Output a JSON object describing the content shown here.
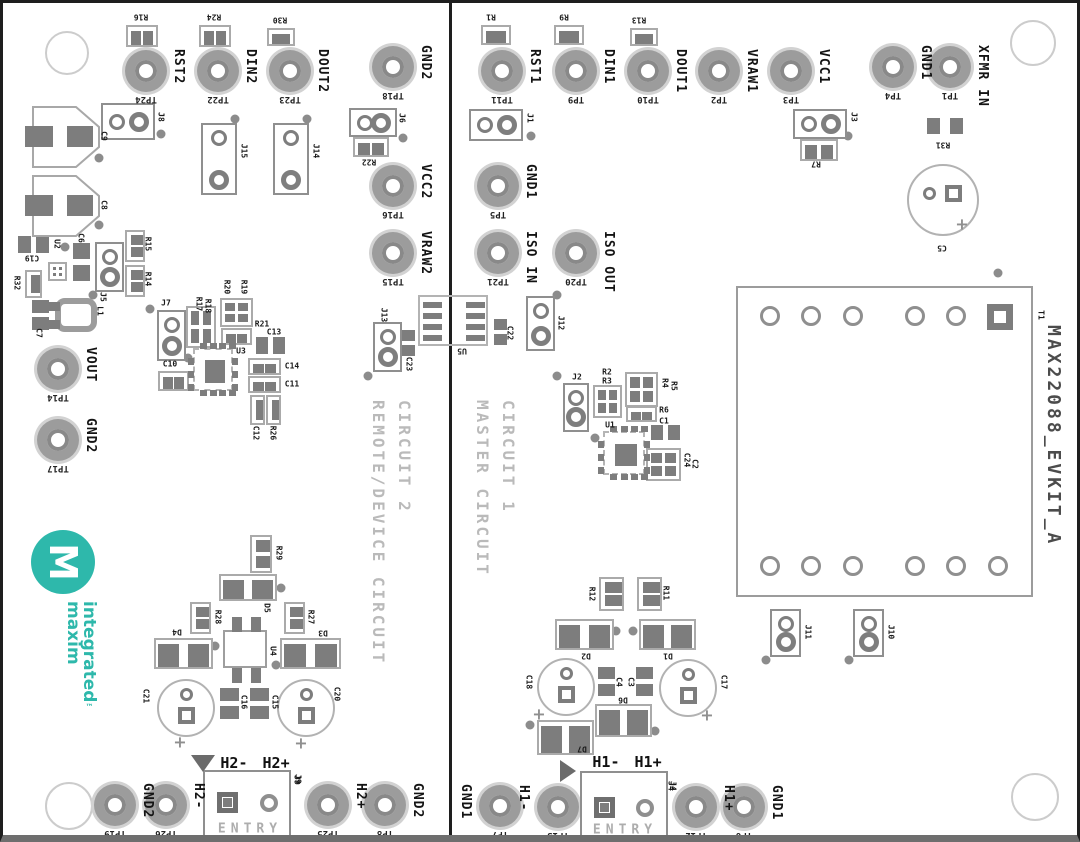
{
  "board_title": "MAX22088_EVKIT_A",
  "titles": {
    "circuit1_line1": "CIRCUIT 1",
    "circuit1_line2": "MASTER CIRCUIT",
    "circuit2_line1": "CIRCUIT 2",
    "circuit2_line2": "REMOTE/DEVICE CIRCUIT"
  },
  "logo": {
    "word1": "maxim",
    "word2": "integrated",
    "tm": "™",
    "monogram": "M"
  },
  "entry": {
    "label": "ENTRY"
  },
  "colors": {
    "teal": "#2eb8ab",
    "pad": "#7d7d7d",
    "outline": "#aaaaaa",
    "silk": "#1a1a1a",
    "faint": "#bababa",
    "title_gray": "#4c4c4c"
  },
  "testpoints": [
    {
      "net": "RST2",
      "tp": "TP24",
      "x": 143,
      "y": 68
    },
    {
      "net": "DIN2",
      "tp": "TP22",
      "x": 215,
      "y": 68
    },
    {
      "net": "DOUT2",
      "tp": "TP23",
      "x": 287,
      "y": 68
    },
    {
      "net": "GND2",
      "tp": "TP18",
      "x": 390,
      "y": 64
    },
    {
      "net": "VCC2",
      "tp": "TP16",
      "x": 390,
      "y": 183
    },
    {
      "net": "VRAW2",
      "tp": "TP15",
      "x": 390,
      "y": 250
    },
    {
      "net": "VOUT",
      "tp": "TP14",
      "x": 55,
      "y": 366
    },
    {
      "net": "GND2",
      "tp": "TP17",
      "x": 55,
      "y": 437
    },
    {
      "net": "GND2",
      "tp": "TP19",
      "x": 112,
      "y": 802
    },
    {
      "net": "H2-",
      "tp": "TP26",
      "x": 163,
      "y": 802
    },
    {
      "net": "H2+",
      "tp": "TP25",
      "x": 325,
      "y": 802
    },
    {
      "net": "GND2",
      "tp": "TP8",
      "x": 382,
      "y": 802
    },
    {
      "net": "RST1",
      "tp": "TP11",
      "x": 499,
      "y": 68
    },
    {
      "net": "DIN1",
      "tp": "TP9",
      "x": 573,
      "y": 68
    },
    {
      "net": "DOUT1",
      "tp": "TP10",
      "x": 645,
      "y": 68
    },
    {
      "net": "VRAW1",
      "tp": "TP2",
      "x": 716,
      "y": 68
    },
    {
      "net": "VCC1",
      "tp": "TP3",
      "x": 788,
      "y": 68
    },
    {
      "net": "GND1",
      "tp": "TP4",
      "x": 890,
      "y": 64
    },
    {
      "net": "XFMR IN",
      "tp": "TP1",
      "x": 947,
      "y": 64
    },
    {
      "net": "GND1",
      "tp": "TP5",
      "x": 495,
      "y": 183
    },
    {
      "net": "ISO IN",
      "tp": "TP21",
      "x": 495,
      "y": 250
    },
    {
      "net": "ISO OUT",
      "tp": "TP20",
      "x": 573,
      "y": 250
    },
    {
      "net": "GND1",
      "tp": "TP7",
      "x": 497,
      "y": 803,
      "side": "left"
    },
    {
      "net": "H1-",
      "tp": "TP13",
      "x": 555,
      "y": 804,
      "side": "left"
    },
    {
      "net": "H1+",
      "tp": "TP12",
      "x": 693,
      "y": 804
    },
    {
      "net": "GND1",
      "tp": "TP6",
      "x": 741,
      "y": 804
    }
  ],
  "jumpers": [
    {
      "r": "J8",
      "x": 98,
      "y": 100,
      "w": 54,
      "h": 37,
      "o": "h"
    },
    {
      "r": "J15",
      "x": 198,
      "y": 120,
      "w": 36,
      "h": 72,
      "o": "v"
    },
    {
      "r": "J14",
      "x": 270,
      "y": 120,
      "w": 36,
      "h": 72,
      "o": "v"
    },
    {
      "r": "J6",
      "x": 346,
      "y": 105,
      "w": 48,
      "h": 29,
      "o": "h"
    },
    {
      "r": "J1",
      "x": 466,
      "y": 106,
      "w": 54,
      "h": 32,
      "o": "h"
    },
    {
      "r": "J3",
      "x": 790,
      "y": 106,
      "w": 54,
      "h": 30,
      "o": "h"
    },
    {
      "r": "J5",
      "x": 92,
      "y": 239,
      "w": 29,
      "h": 50,
      "o": "v"
    },
    {
      "r": "J7",
      "x": 154,
      "y": 307,
      "w": 29,
      "h": 51,
      "o": "v"
    },
    {
      "r": "J13",
      "x": 370,
      "y": 319,
      "w": 29,
      "h": 50,
      "o": "v"
    },
    {
      "r": "J12",
      "x": 523,
      "y": 293,
      "w": 29,
      "h": 55,
      "o": "v"
    },
    {
      "r": "J2",
      "x": 560,
      "y": 380,
      "w": 26,
      "h": 49,
      "o": "v"
    },
    {
      "r": "J11",
      "x": 767,
      "y": 606,
      "w": 31,
      "h": 48,
      "o": "v"
    },
    {
      "r": "J10",
      "x": 850,
      "y": 606,
      "w": 31,
      "h": 48,
      "o": "v"
    }
  ],
  "resistors": [
    {
      "r": "R16",
      "x": 123,
      "y": 22,
      "w": 32,
      "h": 22,
      "o": "h"
    },
    {
      "r": "R24",
      "x": 196,
      "y": 22,
      "w": 32,
      "h": 22,
      "o": "h"
    },
    {
      "r": "R30",
      "x": 264,
      "y": 25,
      "w": 28,
      "h": 18,
      "o": "h"
    },
    {
      "r": "R22",
      "x": 350,
      "y": 134,
      "w": 36,
      "h": 20,
      "o": "h"
    },
    {
      "r": "R1",
      "x": 478,
      "y": 22,
      "w": 30,
      "h": 20,
      "o": "h"
    },
    {
      "r": "R9",
      "x": 551,
      "y": 22,
      "w": 30,
      "h": 20,
      "o": "h"
    },
    {
      "r": "R13",
      "x": 627,
      "y": 25,
      "w": 28,
      "h": 18,
      "o": "h"
    },
    {
      "r": "R7",
      "x": 797,
      "y": 136,
      "w": 38,
      "h": 22,
      "o": "h"
    },
    {
      "r": "R31",
      "x": 921,
      "y": 111,
      "w": 42,
      "h": 24,
      "o": "h",
      "outline": false
    },
    {
      "r": "R15",
      "x": 122,
      "y": 227,
      "w": 20,
      "h": 32,
      "o": "v"
    },
    {
      "r": "R14",
      "x": 122,
      "y": 262,
      "w": 20,
      "h": 32,
      "o": "v"
    },
    {
      "r": "R32",
      "x": 22,
      "y": 267,
      "w": 17,
      "h": 28,
      "o": "v"
    },
    {
      "r": "R29",
      "x": 247,
      "y": 532,
      "w": 22,
      "h": 38,
      "o": "v"
    },
    {
      "r": "R28",
      "x": 187,
      "y": 599,
      "w": 21,
      "h": 32,
      "o": "v"
    },
    {
      "r": "R27",
      "x": 281,
      "y": 599,
      "w": 21,
      "h": 32,
      "o": "v"
    },
    {
      "r": "R12",
      "x": 596,
      "y": 574,
      "w": 25,
      "h": 34,
      "o": "v"
    },
    {
      "r": "R11",
      "x": 634,
      "y": 574,
      "w": 25,
      "h": 34,
      "o": "v"
    },
    {
      "r": "C12",
      "x": 247,
      "y": 392,
      "w": 15,
      "h": 30,
      "o": "v"
    },
    {
      "r": "R26",
      "x": 263,
      "y": 392,
      "w": 15,
      "h": 30,
      "o": "v"
    },
    {
      "r": "R21",
      "x": 218,
      "y": 325,
      "w": 31,
      "h": 17,
      "o": "h"
    },
    {
      "r": "R6",
      "x": 623,
      "y": 403,
      "w": 31,
      "h": 16,
      "o": "h"
    },
    {
      "r": "C10",
      "x": 155,
      "y": 368,
      "w": 31,
      "h": 20,
      "o": "h"
    },
    {
      "r": "C14",
      "x": 245,
      "y": 355,
      "w": 33,
      "h": 17,
      "o": "h"
    },
    {
      "r": "C11",
      "x": 245,
      "y": 373,
      "w": 33,
      "h": 17,
      "o": "h"
    }
  ],
  "cap_pads": [
    {
      "r": "C19",
      "x": 15,
      "y": 233,
      "w": 31,
      "h": 17,
      "o": "h"
    },
    {
      "r": "C6",
      "x": 70,
      "y": 240,
      "w": 17,
      "h": 38,
      "o": "v"
    },
    {
      "r": "C7",
      "x": 29,
      "y": 297,
      "w": 17,
      "h": 30,
      "o": "v"
    },
    {
      "r": "C13",
      "x": 253,
      "y": 334,
      "w": 29,
      "h": 17,
      "o": "h"
    },
    {
      "r": "C23",
      "x": 399,
      "y": 327,
      "w": 13,
      "h": 26,
      "o": "v"
    },
    {
      "r": "C22",
      "x": 491,
      "y": 316,
      "w": 13,
      "h": 26,
      "o": "v"
    },
    {
      "r": "C1",
      "x": 648,
      "y": 422,
      "w": 29,
      "h": 15,
      "o": "h"
    },
    {
      "r": "C16",
      "x": 217,
      "y": 685,
      "w": 19,
      "h": 31,
      "o": "v"
    },
    {
      "r": "C15",
      "x": 247,
      "y": 685,
      "w": 19,
      "h": 31,
      "o": "v"
    },
    {
      "r": "C4",
      "x": 595,
      "y": 664,
      "w": 17,
      "h": 29,
      "o": "v"
    },
    {
      "r": "C3",
      "x": 633,
      "y": 664,
      "w": 17,
      "h": 29,
      "o": "v"
    }
  ],
  "quads": [
    {
      "r": "R17R18",
      "x": 183,
      "y": 303,
      "w": 30,
      "h": 42
    },
    {
      "r": "R20R19",
      "x": 217,
      "y": 295,
      "w": 33,
      "h": 29
    },
    {
      "r": "R2R3",
      "x": 590,
      "y": 382,
      "w": 29,
      "h": 33
    },
    {
      "r": "R4R5",
      "x": 622,
      "y": 369,
      "w": 33,
      "h": 35
    },
    {
      "r": "C24C2",
      "x": 643,
      "y": 445,
      "w": 35,
      "h": 33
    },
    {
      "r": "U2AUX",
      "x": 45,
      "y": 259,
      "w": 19,
      "h": 19
    }
  ],
  "diodes": [
    {
      "r": "D5",
      "x": 216,
      "y": 571,
      "w": 58,
      "h": 27
    },
    {
      "r": "D4",
      "x": 151,
      "y": 635,
      "w": 59,
      "h": 31
    },
    {
      "r": "D3",
      "x": 277,
      "y": 635,
      "w": 61,
      "h": 31
    },
    {
      "r": "D2",
      "x": 552,
      "y": 616,
      "w": 59,
      "h": 31
    },
    {
      "r": "D1",
      "x": 636,
      "y": 616,
      "w": 57,
      "h": 31
    },
    {
      "r": "D6",
      "x": 592,
      "y": 701,
      "w": 57,
      "h": 33
    },
    {
      "r": "D7",
      "x": 534,
      "y": 717,
      "w": 57,
      "h": 35
    }
  ],
  "ecaps": [
    {
      "r": "C5",
      "cx": 940,
      "cy": 197,
      "rad": 36,
      "icx": 926,
      "icy": 190,
      "sqx": 942,
      "sqy": 182,
      "px": 959,
      "py": 221
    },
    {
      "r": "C21",
      "cx": 183,
      "cy": 705,
      "rad": 29,
      "icx": 183,
      "icy": 691,
      "sqx": 175,
      "sqy": 704,
      "px": 177,
      "py": 739
    },
    {
      "r": "C20",
      "cx": 303,
      "cy": 705,
      "rad": 29,
      "icx": 303,
      "icy": 691,
      "sqx": 295,
      "sqy": 704,
      "px": 298,
      "py": 740
    },
    {
      "r": "C18",
      "cx": 563,
      "cy": 684,
      "rad": 29,
      "icx": 563,
      "icy": 670,
      "sqx": 555,
      "sqy": 683,
      "px": 536,
      "py": 711
    },
    {
      "r": "C17",
      "cx": 685,
      "cy": 685,
      "rad": 29,
      "icx": 685,
      "icy": 671,
      "sqx": 677,
      "sqy": 684,
      "px": 704,
      "py": 712
    }
  ],
  "ics": [
    {
      "r": "U3",
      "x": 190,
      "y": 345,
      "w": 40,
      "h": 43
    },
    {
      "r": "U1",
      "x": 600,
      "y": 428,
      "w": 42,
      "h": 44
    }
  ],
  "u4": {
    "r": "U4",
    "x": 220,
    "y": 627,
    "w": 44,
    "h": 38
  },
  "u5": {
    "r": "U5",
    "x": 415,
    "y": 292,
    "w": 70,
    "h": 51
  },
  "bigcaps": [
    {
      "r": "C9",
      "x": 29,
      "y": 103
    },
    {
      "r": "C8",
      "x": 29,
      "y": 172
    }
  ],
  "inductor": {
    "r": "L1",
    "x": 52,
    "y": 295,
    "w": 42,
    "h": 34
  },
  "transformer": {
    "r": "T1",
    "x": 733,
    "y": 283,
    "w": 297,
    "h": 311,
    "top_cy": 313,
    "bottom_cy": 563,
    "pins_top_cx": [
      767,
      808,
      850,
      912,
      953
    ],
    "square": [
      984,
      301
    ],
    "pins_bottom_cx": [
      767,
      808,
      850,
      912,
      953,
      995
    ]
  },
  "entries": [
    {
      "ref": "J9",
      "x": 200,
      "y": 767,
      "w": 88,
      "h": 75,
      "header": "H2- H2+",
      "hx": 252,
      "hy": 760,
      "tri": "down",
      "tx": 188,
      "ty": 752,
      "sq": [
        214,
        789
      ],
      "circ": [
        257,
        791
      ],
      "ex": 247,
      "ey": 826,
      "rx": 294,
      "ry": 777
    },
    {
      "ref": "J4",
      "x": 577,
      "y": 768,
      "w": 88,
      "h": 74,
      "header": "H1- H1+",
      "hx": 624,
      "hy": 759,
      "tri": "right",
      "tx": 557,
      "ty": 757,
      "sq": [
        591,
        794
      ],
      "circ": [
        633,
        796
      ],
      "ex": 622,
      "ey": 827,
      "rx": 668,
      "ry": 783
    }
  ],
  "labels": [
    {
      "t": "R16",
      "x": 138,
      "y": 14,
      "r": 180
    },
    {
      "t": "R24",
      "x": 211,
      "y": 14,
      "r": 180
    },
    {
      "t": "R30",
      "x": 277,
      "y": 17,
      "r": 180
    },
    {
      "t": "J8",
      "x": 158,
      "y": 114,
      "r": 90
    },
    {
      "t": "J15",
      "x": 241,
      "y": 148,
      "r": 90
    },
    {
      "t": "J14",
      "x": 313,
      "y": 148,
      "r": 90
    },
    {
      "t": "J6",
      "x": 399,
      "y": 115,
      "r": 90
    },
    {
      "t": "R22",
      "x": 366,
      "y": 159,
      "r": 180
    },
    {
      "t": "C9",
      "x": 101,
      "y": 133,
      "r": 90
    },
    {
      "t": "C8",
      "x": 101,
      "y": 202,
      "r": 90
    },
    {
      "t": "C19",
      "x": 29,
      "y": 255,
      "r": 180
    },
    {
      "t": "U2",
      "x": 54,
      "y": 241,
      "r": 90
    },
    {
      "t": "C6",
      "x": 78,
      "y": 235,
      "r": 90
    },
    {
      "t": "R32",
      "x": 14,
      "y": 280,
      "r": 90
    },
    {
      "t": "J5",
      "x": 100,
      "y": 294,
      "r": 90
    },
    {
      "t": "R15",
      "x": 145,
      "y": 241,
      "r": 90
    },
    {
      "t": "R14",
      "x": 145,
      "y": 276,
      "r": 90
    },
    {
      "t": "C7",
      "x": 36,
      "y": 330,
      "r": 90
    },
    {
      "t": "L1",
      "x": 97,
      "y": 308,
      "r": 90
    },
    {
      "t": "J7",
      "x": 163,
      "y": 300,
      "r": 0
    },
    {
      "t": "R17",
      "x": 196,
      "y": 301,
      "r": 90
    },
    {
      "t": "R18",
      "x": 205,
      "y": 303,
      "r": 90
    },
    {
      "t": "R20",
      "x": 224,
      "y": 284,
      "r": 90
    },
    {
      "t": "R19",
      "x": 241,
      "y": 284,
      "r": 90
    },
    {
      "t": "R21",
      "x": 259,
      "y": 321,
      "r": 0
    },
    {
      "t": "C13",
      "x": 271,
      "y": 329,
      "r": 0
    },
    {
      "t": "U3",
      "x": 238,
      "y": 348,
      "r": 0
    },
    {
      "t": "C10",
      "x": 167,
      "y": 361,
      "r": 0
    },
    {
      "t": "C14",
      "x": 289,
      "y": 363,
      "r": 0
    },
    {
      "t": "C11",
      "x": 289,
      "y": 381,
      "r": 0
    },
    {
      "t": "C12",
      "x": 253,
      "y": 430,
      "r": 90
    },
    {
      "t": "R26",
      "x": 270,
      "y": 430,
      "r": 90
    },
    {
      "t": "J13",
      "x": 381,
      "y": 312,
      "r": 90
    },
    {
      "t": "C23",
      "x": 406,
      "y": 361,
      "r": 90
    },
    {
      "t": "U5",
      "x": 459,
      "y": 348,
      "r": 180
    },
    {
      "t": "C22",
      "x": 507,
      "y": 330,
      "r": 90
    },
    {
      "t": "J12",
      "x": 558,
      "y": 320,
      "r": 90
    },
    {
      "t": "R1",
      "x": 488,
      "y": 14,
      "r": 180
    },
    {
      "t": "R9",
      "x": 561,
      "y": 14,
      "r": 180
    },
    {
      "t": "R13",
      "x": 636,
      "y": 17,
      "r": 180
    },
    {
      "t": "J1",
      "x": 527,
      "y": 115,
      "r": 90
    },
    {
      "t": "J3",
      "x": 851,
      "y": 114,
      "r": 90
    },
    {
      "t": "R7",
      "x": 813,
      "y": 161,
      "r": 180
    },
    {
      "t": "R31",
      "x": 940,
      "y": 142,
      "r": 180
    },
    {
      "t": "C5",
      "x": 939,
      "y": 245,
      "r": 180
    },
    {
      "t": "T1",
      "x": 1038,
      "y": 312,
      "r": 90
    },
    {
      "t": "J2",
      "x": 574,
      "y": 374,
      "r": 0
    },
    {
      "t": "R2",
      "x": 604,
      "y": 369,
      "r": 0
    },
    {
      "t": "R3",
      "x": 604,
      "y": 378,
      "r": 0
    },
    {
      "t": "R4",
      "x": 662,
      "y": 380,
      "r": 90
    },
    {
      "t": "R5",
      "x": 671,
      "y": 383,
      "r": 90
    },
    {
      "t": "R6",
      "x": 661,
      "y": 407,
      "r": 0
    },
    {
      "t": "C1",
      "x": 661,
      "y": 418,
      "r": 0
    },
    {
      "t": "U1",
      "x": 607,
      "y": 422,
      "r": 0
    },
    {
      "t": "C24",
      "x": 684,
      "y": 457,
      "r": 90
    },
    {
      "t": "C2",
      "x": 692,
      "y": 461,
      "r": 90
    },
    {
      "t": "J11",
      "x": 805,
      "y": 629,
      "r": 90
    },
    {
      "t": "J10",
      "x": 888,
      "y": 629,
      "r": 90
    },
    {
      "t": "R12",
      "x": 589,
      "y": 591,
      "r": 90
    },
    {
      "t": "R11",
      "x": 663,
      "y": 590,
      "r": 90
    },
    {
      "t": "D2",
      "x": 583,
      "y": 653,
      "r": 180
    },
    {
      "t": "D1",
      "x": 665,
      "y": 653,
      "r": 180
    },
    {
      "t": "C18",
      "x": 526,
      "y": 679,
      "r": 90
    },
    {
      "t": "C4",
      "x": 616,
      "y": 679,
      "r": 90
    },
    {
      "t": "C3",
      "x": 628,
      "y": 679,
      "r": 90
    },
    {
      "t": "C17",
      "x": 721,
      "y": 679,
      "r": 90
    },
    {
      "t": "D6",
      "x": 620,
      "y": 697,
      "r": 180
    },
    {
      "t": "D7",
      "x": 579,
      "y": 746,
      "r": 180
    },
    {
      "t": "C21",
      "x": 143,
      "y": 693,
      "r": 90
    },
    {
      "t": "C16",
      "x": 241,
      "y": 699,
      "r": 90
    },
    {
      "t": "C15",
      "x": 272,
      "y": 699,
      "r": 90
    },
    {
      "t": "C20",
      "x": 334,
      "y": 691,
      "r": 90
    },
    {
      "t": "D5",
      "x": 264,
      "y": 605,
      "r": 90
    },
    {
      "t": "D4",
      "x": 174,
      "y": 629,
      "r": 180
    },
    {
      "t": "D3",
      "x": 320,
      "y": 630,
      "r": 180
    },
    {
      "t": "R28",
      "x": 215,
      "y": 614,
      "r": 90
    },
    {
      "t": "R27",
      "x": 308,
      "y": 614,
      "r": 90
    },
    {
      "t": "R29",
      "x": 276,
      "y": 550,
      "r": 90
    },
    {
      "t": "U4",
      "x": 270,
      "y": 648,
      "r": 90
    },
    {
      "t": "J9",
      "x": 295,
      "y": 776,
      "r": 90
    },
    {
      "t": "J4",
      "x": 670,
      "y": 783,
      "r": 90
    }
  ],
  "dots": [
    [
      158,
      131
    ],
    [
      232,
      116
    ],
    [
      304,
      116
    ],
    [
      400,
      135
    ],
    [
      96,
      155
    ],
    [
      96,
      222
    ],
    [
      62,
      244
    ],
    [
      90,
      292
    ],
    [
      147,
      306
    ],
    [
      185,
      355
    ],
    [
      365,
      373
    ],
    [
      554,
      292
    ],
    [
      554,
      373
    ],
    [
      528,
      133
    ],
    [
      845,
      133
    ],
    [
      995,
      270
    ],
    [
      763,
      657
    ],
    [
      846,
      657
    ],
    [
      592,
      435
    ],
    [
      278,
      585
    ],
    [
      212,
      643
    ],
    [
      273,
      662
    ],
    [
      613,
      628
    ],
    [
      630,
      628
    ],
    [
      652,
      728
    ],
    [
      527,
      722
    ]
  ],
  "holes": [
    {
      "x": 62,
      "y": 48,
      "rad": 20
    },
    {
      "x": 1028,
      "y": 38,
      "rad": 21
    },
    {
      "x": 64,
      "y": 801,
      "rad": 22
    },
    {
      "x": 1030,
      "y": 792,
      "rad": 22
    }
  ]
}
